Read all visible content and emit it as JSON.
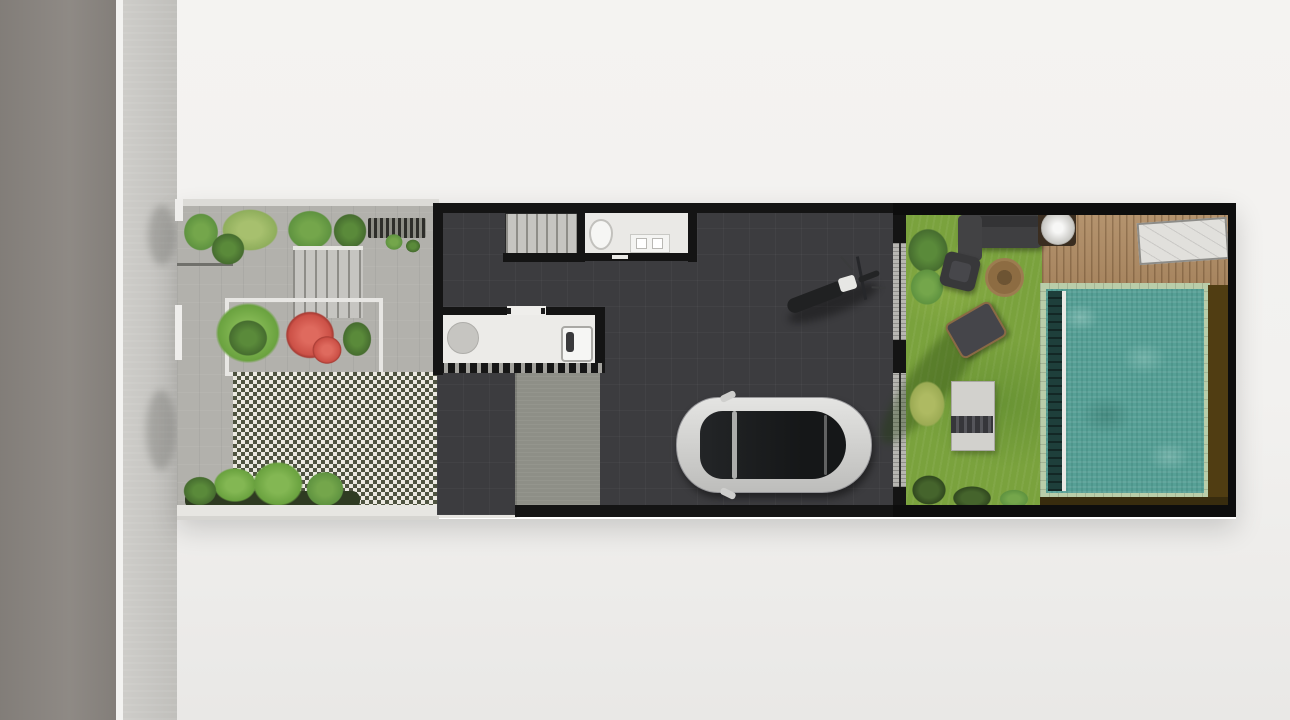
{
  "scene": {
    "kind": "architectural-site-plan-top-view",
    "objects": [
      "street",
      "sidewalk",
      "front-garden",
      "entry-gate",
      "entry-steps",
      "red-bougainvillea-planter",
      "grass-block-paving-driveway",
      "house-staircase",
      "bathroom",
      "kitchen-counter",
      "carport",
      "car",
      "motorcycle",
      "sliding-glass-doors",
      "backyard-lawn",
      "outdoor-sofa",
      "armchair",
      "fire-pit",
      "lounge-chair",
      "garden-table",
      "shrubs",
      "wood-deck",
      "deck-round-table",
      "sun-lounger",
      "swimming-pool"
    ]
  },
  "palette": {
    "page_bg": "#f2f1ef",
    "road": "#8a8580",
    "curb": "#f3f3f1",
    "sidewalk": "#c8c7c3",
    "front_paving": "#b2b1ac",
    "paving_edge": "#dcdbd7",
    "checker_light": "#ebe9e1",
    "checker_dark": "#4e5340",
    "wall": "#141414",
    "house_floor": "#3c3c3f",
    "stairs": "#c6c5c1",
    "bathroom_floor": "#eae9e6",
    "kitchen_counter": "#ecebe8",
    "table_circle": "#c6c5c1",
    "sink": "#f6f6f4",
    "concrete_pad": "#8e8f87",
    "door_glass": "#b7b6b2",
    "car_body": "#d8d8d6",
    "car_glass": "#1b1d1e",
    "moto_body": "#202122",
    "moto_tank": "#e7e7e4",
    "grass": "#7aa23d",
    "foliage_dark": "#466d2f",
    "foliage_mid": "#5f9340",
    "foliage_light": "#8fae5c",
    "red_shrub": "#cc5147",
    "palm_green": "#6aa23f",
    "shrub_yellow": "#9cab54",
    "sofa": "#3f3f41",
    "armchair": "#38383a",
    "firepit": "#8d6c42",
    "garden_table": "#d2d1cd",
    "deck_wood": "#b08c64",
    "deck_table": "#d9d8d4",
    "sun_lounger": "#e1e0dc",
    "pool_coping": "#b9cda9",
    "pool_water": "#56a096",
    "pool_trough": "#1e3f3b",
    "side_brown": "#503d12",
    "bottom_brown": "#382c0e",
    "white_planter": "#e7e6e2"
  }
}
